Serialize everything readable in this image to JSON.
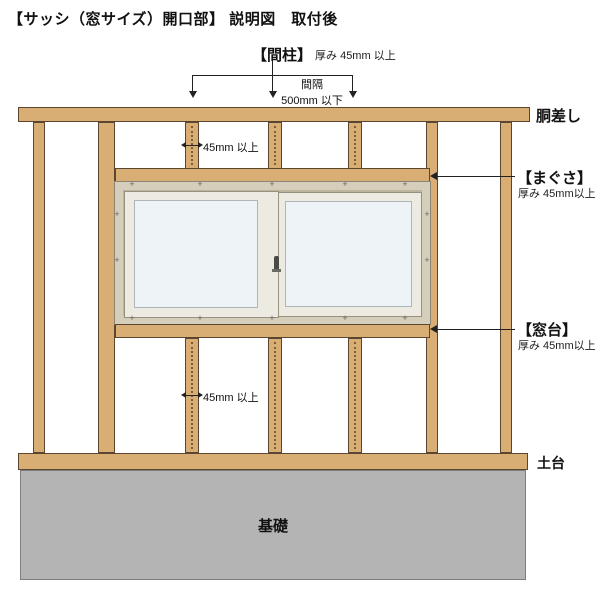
{
  "title": "【サッシ（窓サイズ）開口部】 説明図　取付後",
  "labels": {
    "mabashira": "【間柱】",
    "mabashira_note": "厚み 45mm 以上",
    "spacing_line1": "間隔",
    "spacing_line2": "500mm 以下",
    "stud_width_top": "45mm 以上",
    "stud_width_bottom": "45mm 以上",
    "dousashi": "胴差し",
    "magusa": "【まぐさ】",
    "magusa_note": "厚み 45mm以上",
    "madodai": "【窓台】",
    "madodai_note": "厚み 45mm以上",
    "dodai": "土台",
    "kiso": "基礎"
  },
  "window": {
    "nail_mark": "+"
  },
  "colors": {
    "wood": "#d9ae75",
    "wood_outline": "#5a4631",
    "window_frame_beige": "#d5cebb",
    "sash_white": "#edeae1",
    "glass": "#eef3f7",
    "foundation_gray": "#b4b4b4",
    "line": "#222222"
  }
}
